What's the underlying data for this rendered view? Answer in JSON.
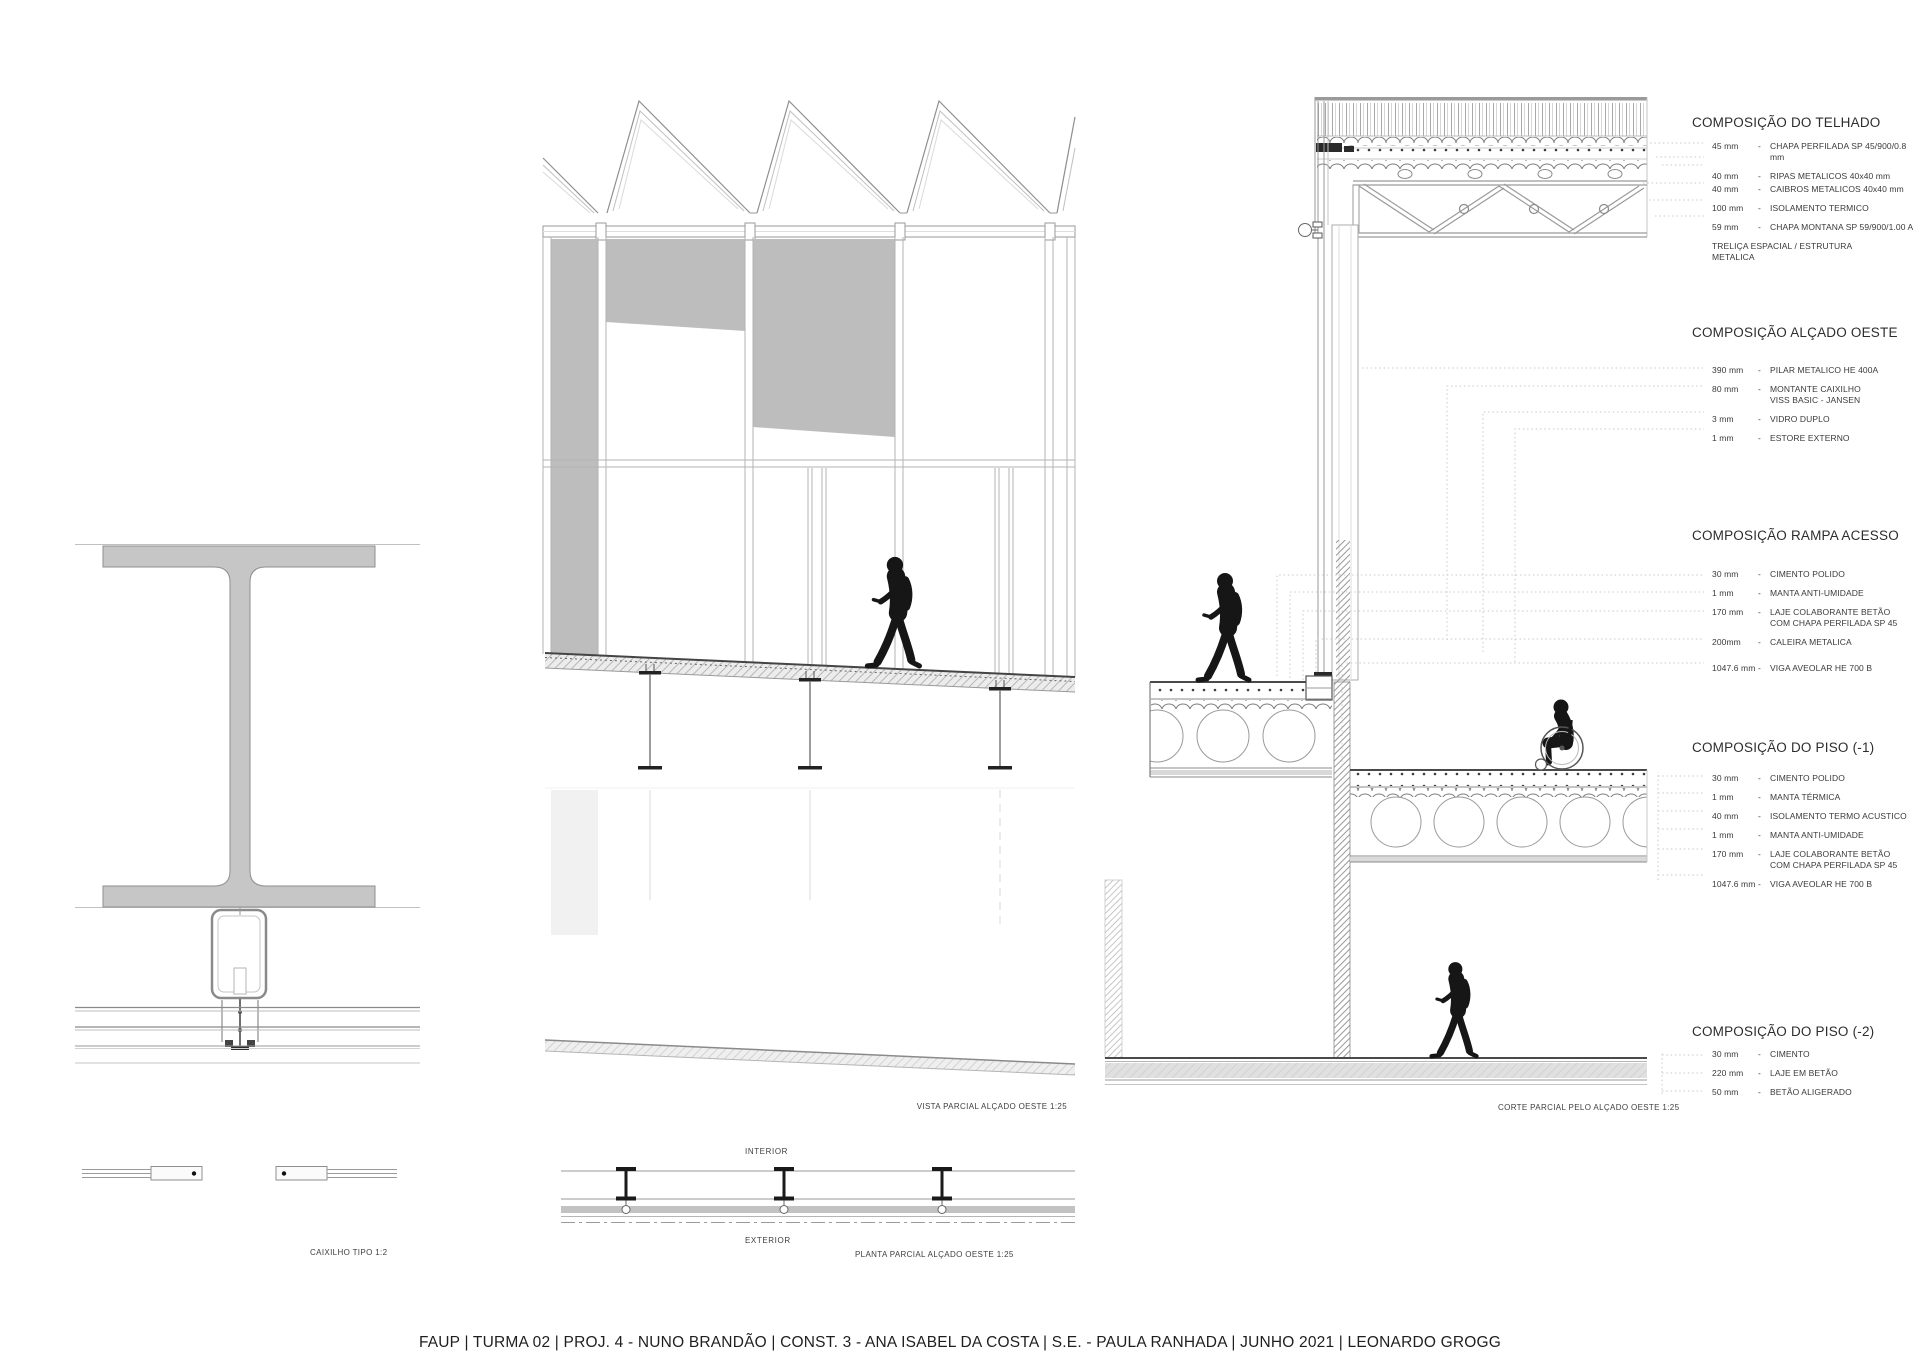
{
  "title_bar": "FAUP | TURMA 02 | PROJ. 4 - NUNO BRANDÃO | CONST. 3 - ANA ISABEL DA COSTA | S.E. - PAULA RANHADA | JUNHO 2021 | LEONARDO GROGG",
  "captions": {
    "caixilho": "CAIXILHO TIPO 1:2",
    "vista": "VISTA PARCIAL ALÇADO OESTE 1:25",
    "planta": "PLANTA PARCIAL ALÇADO OESTE 1:25",
    "corte": "CORTE PARCIAL PELO ALÇADO OESTE 1:25",
    "interior": "INTERIOR",
    "exterior": "EXTERIOR"
  },
  "annotation_groups": [
    {
      "id": "telhado",
      "title": "COMPOSIÇÃO DO TELHADO",
      "items": [
        {
          "value": "45 mm",
          "label": "CHAPA PERFILADA SP 45/900/0.8 mm"
        },
        {
          "value": "40 mm",
          "label": "RIPAS METALICOS 40x40 mm"
        },
        {
          "value": "40 mm",
          "label": "CAIBROS METALICOS 40x40 mm",
          "tight": true
        },
        {
          "value": "100 mm",
          "label": "ISOLAMENTO TERMICO"
        },
        {
          "value": "59 mm",
          "label": "CHAPA MONTANA SP 59/900/1.00 A"
        },
        {
          "value": "",
          "label": "TRELIÇA ESPACIAL / ESTRUTURA METALICA"
        }
      ]
    },
    {
      "id": "alcado",
      "title": "COMPOSIÇÃO ALÇADO OESTE",
      "items": [
        {
          "value": "390 mm",
          "label": "PILAR METALICO HE 400A"
        },
        {
          "value": "80 mm",
          "label": "MONTANTE CAIXILHO\nVISS BASIC - JANSEN"
        },
        {
          "value": "3 mm",
          "label": "VIDRO DUPLO"
        },
        {
          "value": "1 mm",
          "label": "ESTORE EXTERNO"
        }
      ]
    },
    {
      "id": "rampa",
      "title": "COMPOSIÇÃO RAMPA ACESSO",
      "items": [
        {
          "value": "30 mm",
          "label": "CIMENTO POLIDO"
        },
        {
          "value": "1 mm",
          "label": "MANTA ANTI-UMIDADE"
        },
        {
          "value": "170 mm",
          "label": "LAJE COLABORANTE BETÃO\nCOM CHAPA PERFILADA SP 45"
        },
        {
          "value": "200mm",
          "label": "CALEIRA METALICA"
        },
        {
          "value": "1047.6 mm",
          "label": "VIGA AVEOLAR HE 700 B",
          "spaced": true
        }
      ]
    },
    {
      "id": "piso1",
      "title": "COMPOSIÇÃO DO PISO (-1)",
      "items": [
        {
          "value": "30 mm",
          "label": "CIMENTO POLIDO"
        },
        {
          "value": "1 mm",
          "label": "MANTA TÉRMICA"
        },
        {
          "value": "40 mm",
          "label": "ISOLAMENTO TERMO ACUSTICO"
        },
        {
          "value": "1 mm",
          "label": "MANTA ANTI-UMIDADE"
        },
        {
          "value": "170 mm",
          "label": "LAJE COLABORANTE BETÃO\nCOM CHAPA PERFILADA SP 45"
        },
        {
          "value": "1047.6 mm",
          "label": "VIGA AVEOLAR HE 700 B"
        }
      ]
    },
    {
      "id": "piso2",
      "title": "COMPOSIÇÃO DO PISO (-2)",
      "items": [
        {
          "value": "30 mm",
          "label": "CIMENTO"
        },
        {
          "value": "220 mm",
          "label": "LAJE EM BETÃO"
        },
        {
          "value": "50 mm",
          "label": "BETÃO ALIGERADO"
        }
      ]
    }
  ],
  "colors": {
    "line_dark": "#555555",
    "line_mid": "#9a9a9a",
    "line_light": "#c4c4c4",
    "steel_fill": "#c6c6c6",
    "shade_fill": "#bdbdbd",
    "silhouette": "#161616"
  }
}
